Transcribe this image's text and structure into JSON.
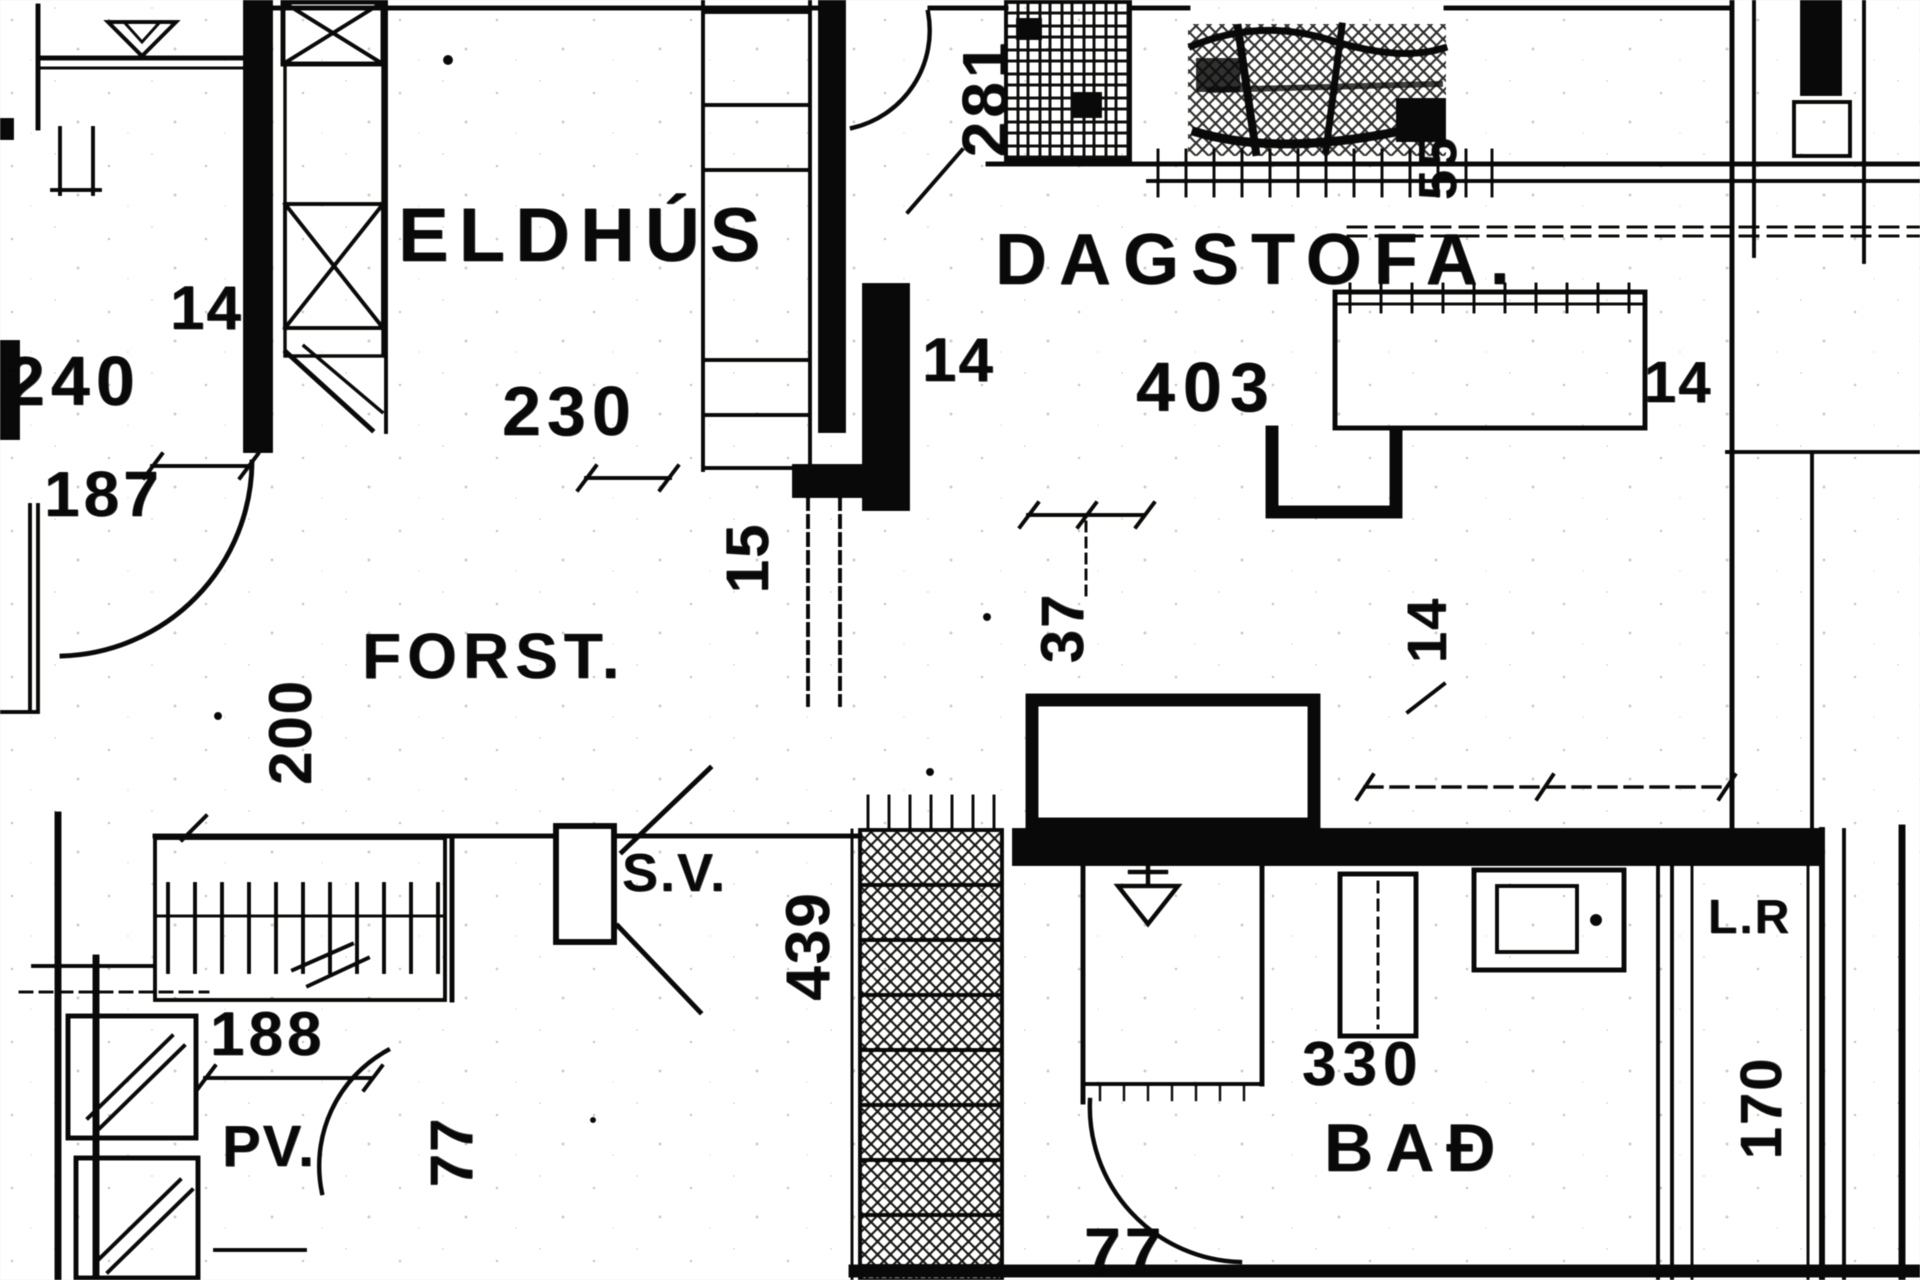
{
  "floor_plan": {
    "ink_color": "#161616",
    "paper_color": "#fcfcf9",
    "labels": [
      {
        "name": "room-eldhus",
        "text": "ELDHÚS",
        "x": 398,
        "y": 198,
        "size": 76,
        "spacing": 10,
        "rotate": 0
      },
      {
        "name": "room-dagstofa",
        "text": "DAGSTOFA.",
        "x": 995,
        "y": 224,
        "size": 72,
        "spacing": 12,
        "rotate": 0
      },
      {
        "name": "room-forst",
        "text": "FORST.",
        "x": 362,
        "y": 624,
        "size": 64,
        "spacing": 6,
        "rotate": 0
      },
      {
        "name": "room-sv",
        "text": "S.V.",
        "x": 622,
        "y": 846,
        "size": 54,
        "spacing": 2,
        "rotate": 0
      },
      {
        "name": "room-bad",
        "text": "BAÐ",
        "x": 1324,
        "y": 1114,
        "size": 68,
        "spacing": 12,
        "rotate": 0
      },
      {
        "name": "room-pv",
        "text": "PV.",
        "x": 222,
        "y": 1118,
        "size": 58,
        "spacing": 2,
        "rotate": 0
      },
      {
        "name": "room-lr",
        "text": "L.R",
        "x": 1708,
        "y": 894,
        "size": 48,
        "spacing": 2,
        "rotate": 0
      },
      {
        "name": "dim-240",
        "text": "240",
        "x": 6,
        "y": 346,
        "size": 70,
        "spacing": 6,
        "rotate": 0
      },
      {
        "name": "dim-187",
        "text": "187",
        "x": 44,
        "y": 462,
        "size": 64,
        "spacing": 4,
        "rotate": 0
      },
      {
        "name": "dim-14-kitchen-door",
        "text": "14",
        "x": 170,
        "y": 278,
        "size": 62,
        "spacing": 2,
        "rotate": 0
      },
      {
        "name": "dim-230",
        "text": "230",
        "x": 502,
        "y": 376,
        "size": 70,
        "spacing": 6,
        "rotate": 0
      },
      {
        "name": "dim-14-passage",
        "text": "14",
        "x": 922,
        "y": 330,
        "size": 62,
        "spacing": 2,
        "rotate": 0
      },
      {
        "name": "dim-403",
        "text": "403",
        "x": 1136,
        "y": 352,
        "size": 70,
        "spacing": 8,
        "rotate": 0
      },
      {
        "name": "dim-14-dagstofa",
        "text": "14",
        "x": 1644,
        "y": 354,
        "size": 58,
        "spacing": 2,
        "rotate": 0
      },
      {
        "name": "dim-188",
        "text": "188",
        "x": 210,
        "y": 1004,
        "size": 62,
        "spacing": 4,
        "rotate": 0
      },
      {
        "name": "dim-330",
        "text": "330",
        "x": 1302,
        "y": 1034,
        "size": 62,
        "spacing": 6,
        "rotate": 0
      },
      {
        "name": "dim-77-bath-door",
        "text": "77",
        "x": 1084,
        "y": 1218,
        "size": 66,
        "spacing": 4,
        "rotate": 0
      },
      {
        "name": "dim-281",
        "text": "281",
        "x": 985,
        "y": 98,
        "size": 64,
        "spacing": 4,
        "rotate": -90
      },
      {
        "name": "dim-15",
        "text": "15",
        "x": 748,
        "y": 558,
        "size": 60,
        "spacing": 2,
        "rotate": -90
      },
      {
        "name": "dim-37",
        "text": "37",
        "x": 1063,
        "y": 628,
        "size": 60,
        "spacing": 2,
        "rotate": -90
      },
      {
        "name": "dim-200",
        "text": "200",
        "x": 291,
        "y": 732,
        "size": 60,
        "spacing": 2,
        "rotate": -90
      },
      {
        "name": "dim-439",
        "text": "439",
        "x": 809,
        "y": 946,
        "size": 62,
        "spacing": 2,
        "rotate": -90
      },
      {
        "name": "dim-77-pv-door",
        "text": "77",
        "x": 452,
        "y": 1152,
        "size": 60,
        "spacing": 2,
        "rotate": -90
      },
      {
        "name": "dim-14-right",
        "text": "14",
        "x": 1427,
        "y": 630,
        "size": 56,
        "spacing": 2,
        "rotate": -90
      },
      {
        "name": "dim-170",
        "text": "170",
        "x": 1762,
        "y": 1108,
        "size": 58,
        "spacing": 2,
        "rotate": -90
      },
      {
        "name": "dim-55",
        "text": "55",
        "x": 1438,
        "y": 168,
        "size": 54,
        "spacing": 2,
        "rotate": -90
      }
    ]
  }
}
